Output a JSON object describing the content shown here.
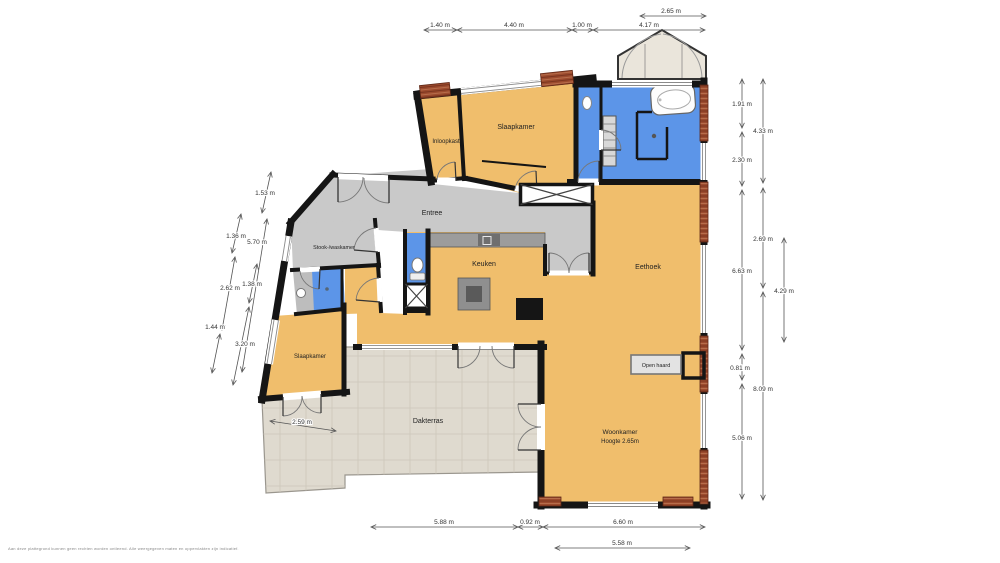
{
  "rooms": {
    "inloopkast": {
      "label": "Inloopkast",
      "color": "#F0BE6C"
    },
    "slaapkamer1": {
      "label": "Slaapkamer",
      "color": "#F0BE6C"
    },
    "slaapkamer2": {
      "label": "Slaapkamer",
      "color": "#F0BE6C"
    },
    "entree": {
      "label": "Entree",
      "color": "#C9C9C9"
    },
    "stook": {
      "label": "Stook-/waskamer",
      "color": "#C9C9C9"
    },
    "keuken": {
      "label": "Keuken",
      "color": "#F0BE6C"
    },
    "eethoek": {
      "label": "Eethoek",
      "color": "#F0BE6C"
    },
    "woonkamer": {
      "label": "Woonkamer",
      "sublabel": "Hoogte 2.65m",
      "color": "#F0BE6C"
    },
    "dakterras": {
      "label": "Dakterras",
      "color": "#DFDACF"
    },
    "open_haard": {
      "label": "Open haard"
    },
    "badkamer": {
      "color": "#5C95E8"
    },
    "toilet": {
      "color": "#5C95E8"
    },
    "douche": {
      "color": "#5C95E8"
    },
    "badkamer2_vloer": {
      "color": "#BDBDBD"
    }
  },
  "dims": {
    "t1": "1.40 m",
    "t2": "4.40 m",
    "t3": "1.00 m",
    "t4": "4.17 m",
    "t5": "2.65 m",
    "r1": "1.91 m",
    "r2": "4.33 m",
    "r3": "2.30 m",
    "r4": "2.69 m",
    "r5": "6.63 m",
    "r6": "4.29 m",
    "r7": "0.81 m",
    "r8": "8.09 m",
    "r9": "5.06 m",
    "l1": "1.53 m",
    "l2": "1.36 m",
    "l3": "5.70 m",
    "l4": "2.62 m",
    "l5": "1.38 m",
    "l6": "1.44 m",
    "l7": "3.20 m",
    "b1": "5.88 m",
    "b2": "0.92 m",
    "b3": "6.60 m",
    "b4": "5.58 m",
    "ter": "2.59 m"
  },
  "colors": {
    "wall": "#151515",
    "brick": "#9C4B2E",
    "brick_line": "#7A351F",
    "terrace_grid": "#CCC6BA",
    "counter": "#9C9C9C",
    "counter_dark": "#6F6F6F",
    "gable": "#EAE5DB",
    "dim_line": "#555555",
    "dim_text": "#333333"
  },
  "footer": {
    "disclaimer": "Aan deze plattegrond kunnen geen rechten worden ontleend. Alle weergegeven maten en oppervlakten zijn indicatief."
  }
}
